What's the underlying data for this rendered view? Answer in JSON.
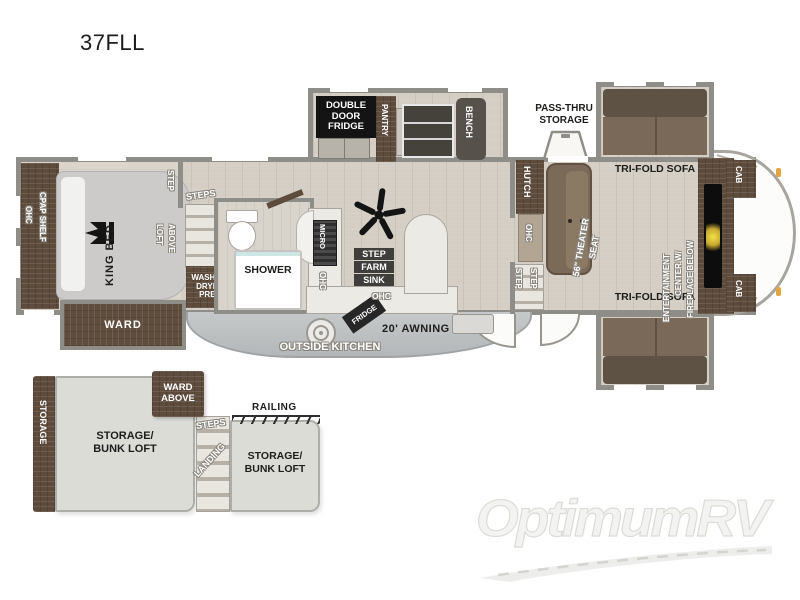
{
  "title": "37FLL",
  "main": {
    "bedroom": {
      "ohc": "OHC",
      "cpap": "CPAP SHELF",
      "king_bed": "KING BED",
      "step": "STEP",
      "loft1": "LOFT",
      "loft2": "ABOVE",
      "ward": "WARD"
    },
    "bath": {
      "steps": "STEPS",
      "wd1": "WASHER/",
      "wd2": "DRYER",
      "wd3": "PREP",
      "shower": "SHOWER"
    },
    "kitchen": {
      "ddf1": "DOUBLE",
      "ddf2": "DOOR",
      "ddf3": "FRIDGE",
      "pantry": "PANTRY",
      "bench": "BENCH",
      "micro": "MICRO",
      "ohc_cab": "OHC",
      "step": "STEP",
      "farm": "FARM",
      "sink": "SINK",
      "ohc_island": "OHC"
    },
    "living": {
      "sofa_top": "TRI-FOLD SOFA",
      "sofa_bottom": "TRI-FOLD SOFA",
      "hutch": "HUTCH",
      "ohc": "OHC",
      "theater1": "56\" THEATER",
      "theater2": "SEAT",
      "step1": "STEP",
      "step2": "STEP",
      "ent1": "ENTERTAINMENT",
      "ent2": "CENTER W/",
      "ent3": "FIREPLACE BELOW",
      "cab_top": "CAB",
      "cab_bottom": "CAB"
    },
    "exterior": {
      "pass1": "PASS-THRU",
      "pass2": "STORAGE",
      "awning": "20' AWNING",
      "outside_kitchen": "OUTSIDE KITCHEN",
      "fridge": "FRIDGE"
    }
  },
  "loft": {
    "storage": "STORAGE",
    "left1": "STORAGE/",
    "left2": "BUNK LOFT",
    "ward1": "WARD",
    "ward2": "ABOVE",
    "steps": "STEPS",
    "railing": "RAILING",
    "landing": "LANDING",
    "right1": "STORAGE/",
    "right2": "BUNK LOFT"
  },
  "watermark": "OptimumRV",
  "colors": {
    "wall": "#8f8d88",
    "wood": "#5d4b3c",
    "floor": "#d5cec5",
    "label_box": "#1a1a1a",
    "fireplace_glow": "#f0dd49",
    "clearance_light": "#e2a53f"
  }
}
